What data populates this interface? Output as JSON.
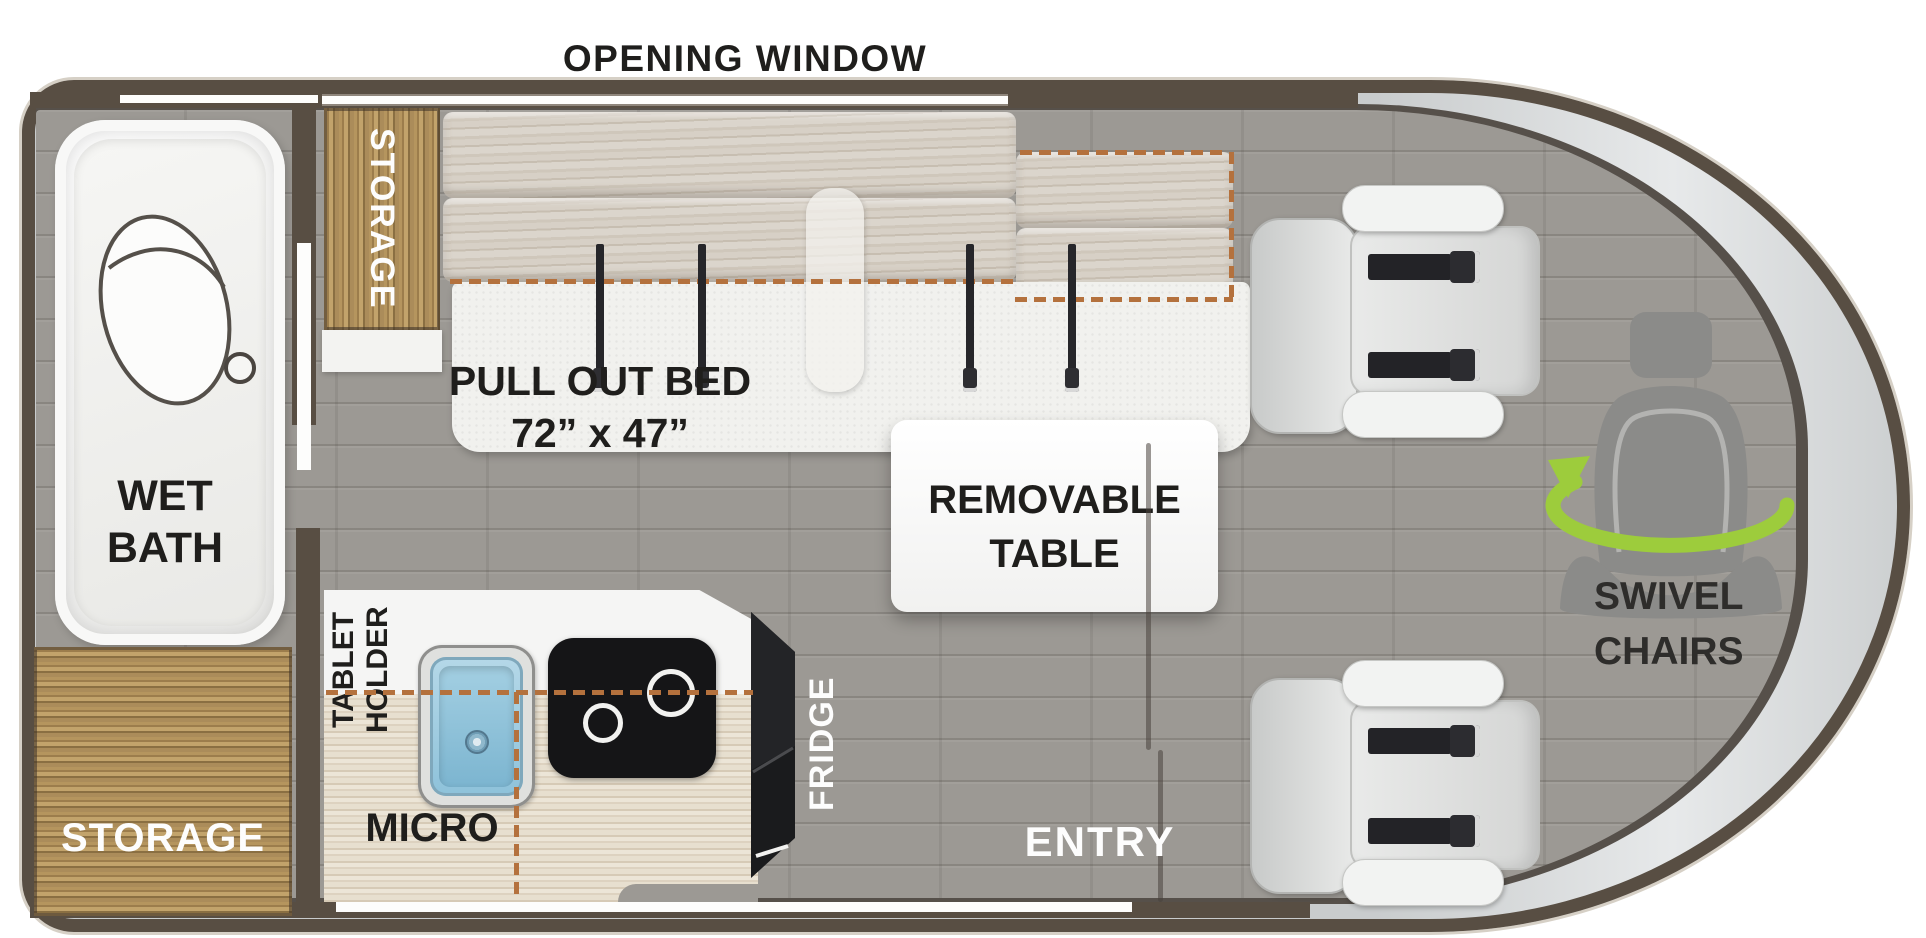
{
  "title": {
    "top_label": "OPENING WINDOW"
  },
  "colors": {
    "accent_green": "#9dcc3c",
    "dash_tan": "#b4713d",
    "wall_brown": "#584e43",
    "wood": "#a98a58",
    "floor_gray": "#9c9994",
    "counter_white": "#f5f5f4",
    "belt_black": "#26262a",
    "text_dark": "#1f1e1c",
    "text_white": "#fdfdfd"
  },
  "areas": {
    "wet_bath": {
      "line1": "WET",
      "line2": "BATH"
    },
    "storage_top": {
      "label": "STORAGE"
    },
    "storage_bottom": {
      "label": "STORAGE"
    },
    "bed": {
      "line1": "PULL OUT BED",
      "line2": "72” x 47”"
    },
    "table": {
      "line1": "REMOVABLE",
      "line2": "TABLE"
    },
    "kitchen": {
      "tablet_line1": "TABLET",
      "tablet_line2": "HOLDER",
      "micro": "MICRO",
      "fridge": "FRIDGE"
    },
    "seating": {
      "line1": "SWIVEL",
      "line2": "CHAIRS"
    },
    "entry": {
      "label": "ENTRY"
    }
  },
  "icons": {
    "toilet": "toilet-icon",
    "drain": "drain-icon",
    "sink": "sink-icon",
    "cooktop_burner": "burner-icon",
    "seatbelt": "seatbelt-icon",
    "swivel_rotation": "swivel-rotation-icon",
    "seat": "seat-icon"
  }
}
